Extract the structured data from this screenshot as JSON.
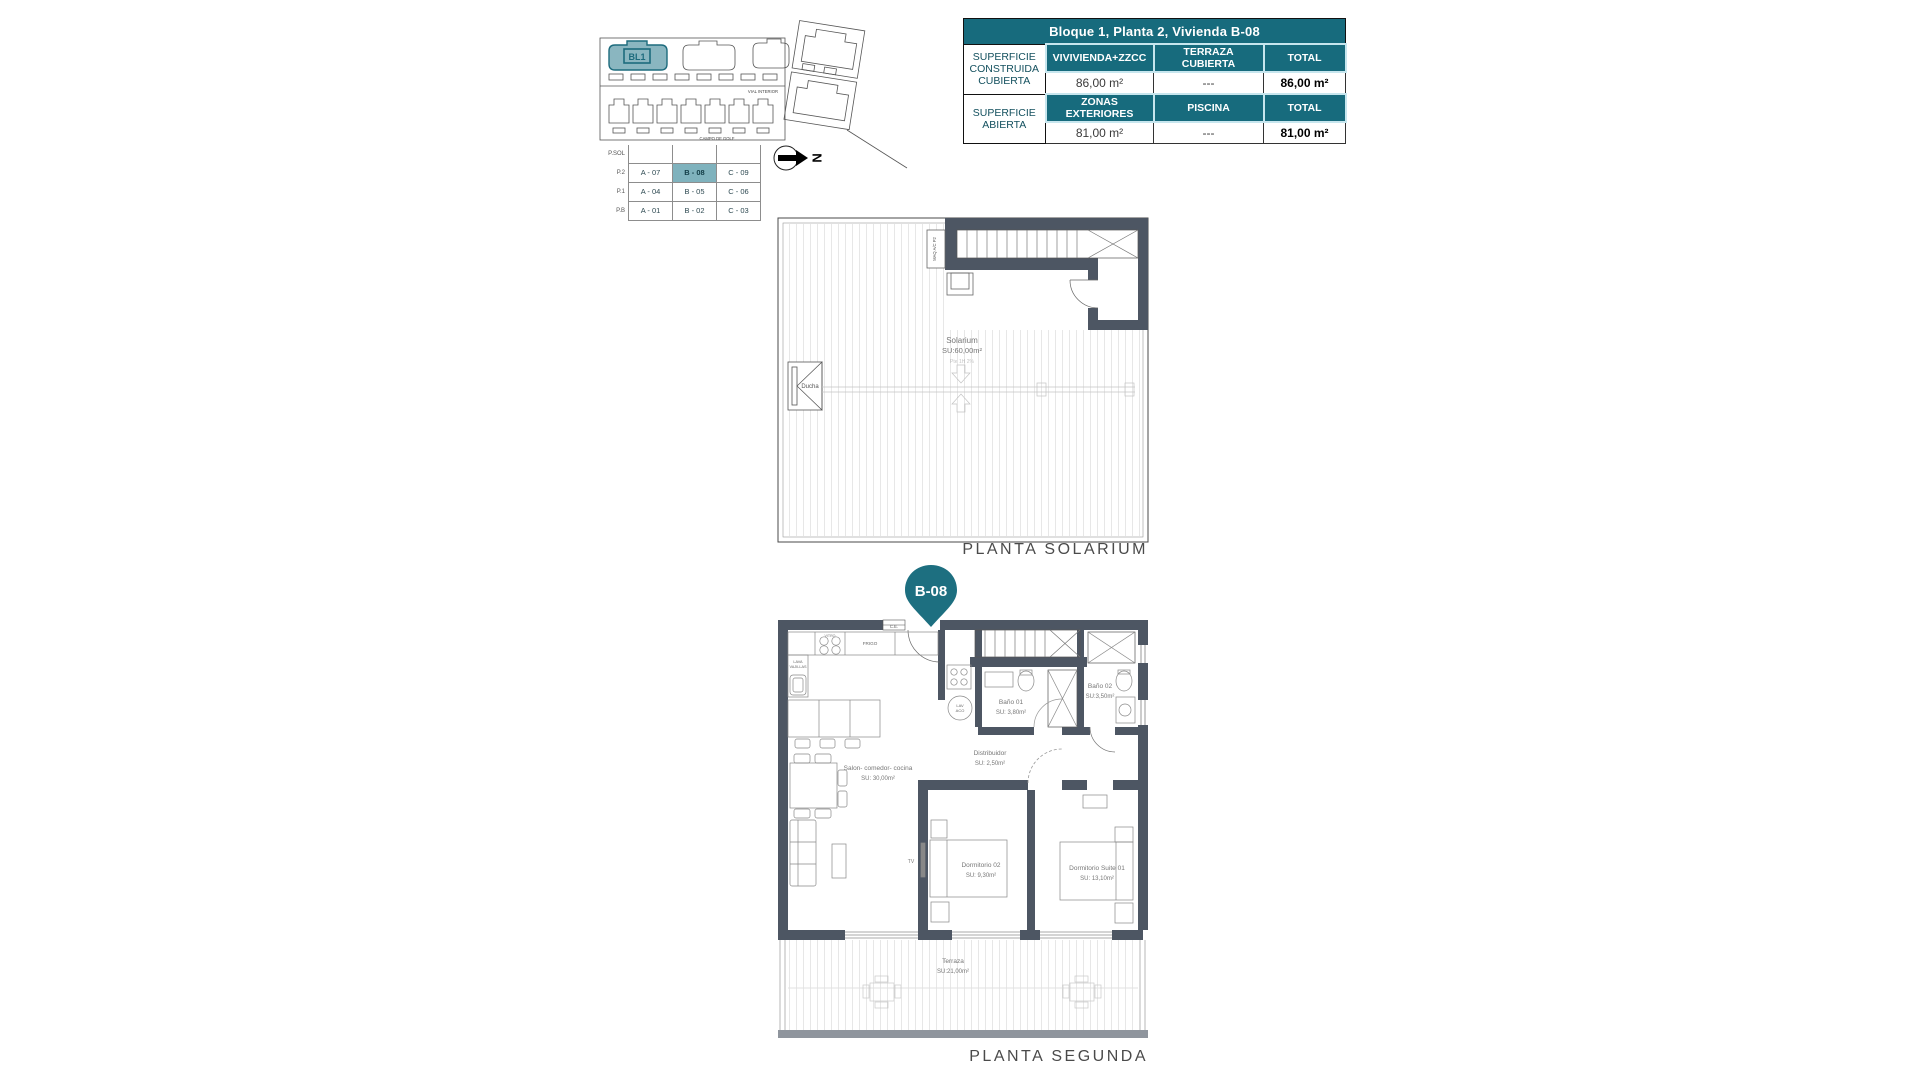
{
  "document": {
    "solarium_title": "PLANTA SOLARIUM",
    "segunda_title": "PLANTA SEGUNDA",
    "unit_pin_label": "B-08"
  },
  "colors": {
    "teal": "#176b7d",
    "teal_light": "#8ab6c0",
    "highlight_cell": "#7fb2bd",
    "wall": "#4d5663"
  },
  "site_plan": {
    "block_label": "BL1",
    "road_label": "VIAL INTERIOR",
    "golf_label": "CAMPO DE GOLF",
    "north_letter": "N"
  },
  "legend_table": {
    "row_headers": [
      "P.SOL",
      "P.2",
      "P.1",
      "P.B"
    ],
    "rows": [
      [
        "",
        "",
        ""
      ],
      [
        "A - 07",
        "B - 08",
        "C - 09"
      ],
      [
        "A - 04",
        "B - 05",
        "C - 06"
      ],
      [
        "A - 01",
        "B - 02",
        "C - 03"
      ]
    ],
    "highlighted_cell": "B - 08"
  },
  "info_table": {
    "title": "Bloque 1, Planta 2, Vivienda B-08",
    "row1_label": "SUPERFICIE CONSTRUIDA CUBIERTA",
    "row1_cols": [
      "VIVIVIENDA+ZZCC",
      "TERRAZA CUBIERTA",
      "TOTAL"
    ],
    "row1_vals": [
      "86,00 m²",
      "---",
      "86,00 m²"
    ],
    "row2_label": "SUPERFICIE ABIERTA",
    "row2_cols": [
      "ZONAS EXTERIORES",
      "PISCINA",
      "TOTAL"
    ],
    "row2_vals": [
      "81,00 m²",
      "---",
      "81,00 m²"
    ]
  },
  "solarium_plan": {
    "room": "Solarium",
    "room_area": "SU:60,00m²",
    "slope_note": "Pte 1H 2%",
    "shower_label": "Ducha",
    "equipment_label": "MAQ A/C P2"
  },
  "segunda_plan": {
    "salon": "Salon- comedor- cocina",
    "salon_area": "SU: 30,00m²",
    "bano1": "Baño 01",
    "bano1_area": "SU: 3,80m²",
    "bano2": "Baño 02",
    "bano2_area": "SU:3,50m²",
    "distribuidor": "Distribuidor",
    "distribuidor_area": "SU: 2,50m²",
    "dorm2": "Dormitorio 02",
    "dorm2_area": "SU: 9,30m²",
    "suite": "Dormitorio Suite 01",
    "suite_area": "SU: 13,10m²",
    "terraza": "Terraza",
    "terraza_area": "SU:21,00m²",
    "frigo": "FRIGO",
    "vitro": "VITRO",
    "lavavajillas_1": "LAVA",
    "lavavajillas_2": "VAJILLAS",
    "lav_1": "LAV",
    "lav_2": "ACO",
    "tv": "TV",
    "ce": "C.E."
  }
}
